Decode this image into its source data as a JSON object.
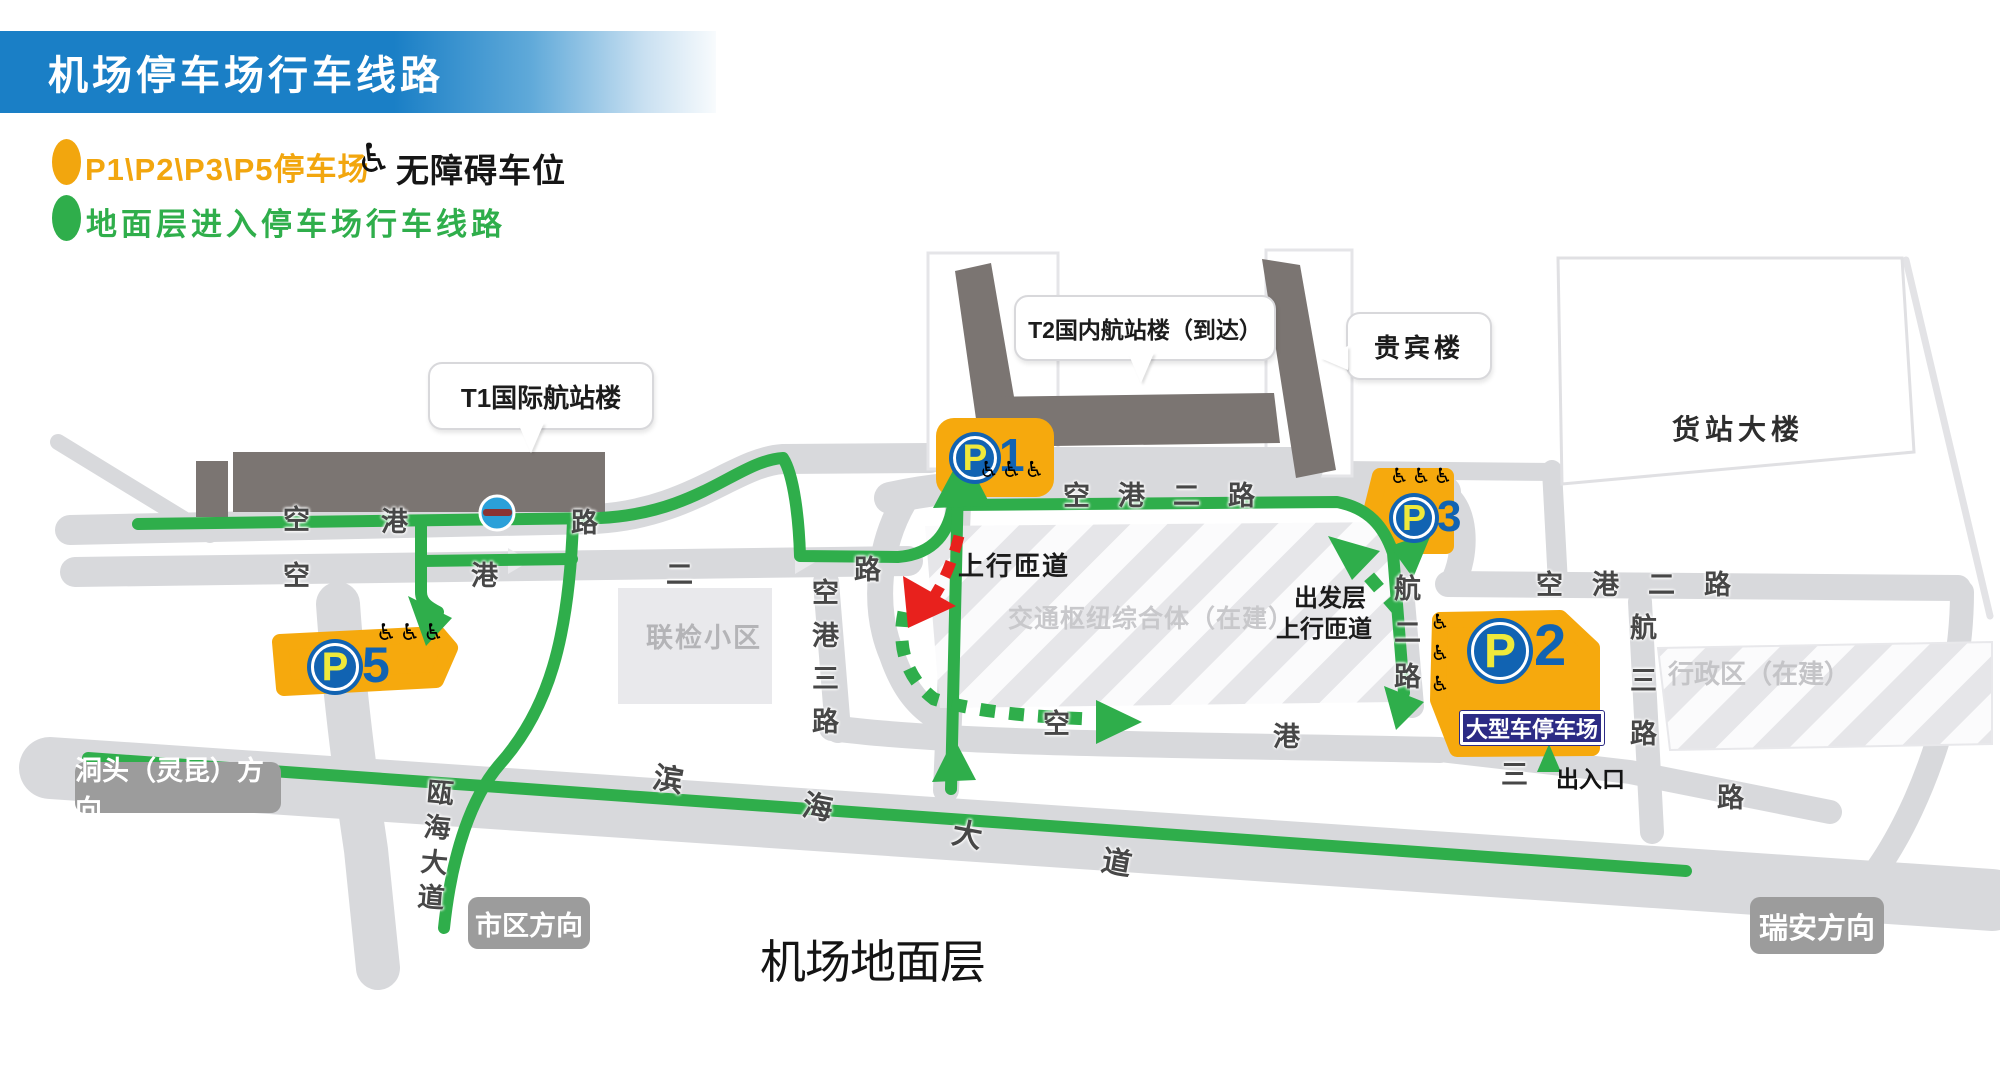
{
  "title": "机场停车场行车线路",
  "legend": {
    "parking_label": "P1\\P2\\P3\\P5停车场",
    "wheelchair_icon": "♿",
    "accessible_label": "无障碍车位",
    "route_label": "地面层进入停车场行车线路",
    "parking_color": "#f2a60e",
    "route_color": "#2fae4b"
  },
  "callouts": {
    "t1": "T1国际航站楼",
    "t2": "T2国内航站楼（到达）",
    "vip": "贵宾楼"
  },
  "zones": {
    "cargo": "货站大楼",
    "inspection": "联检小区",
    "hub": "交通枢纽综合体（在建）",
    "admin": "行政区（在建）"
  },
  "parking": {
    "p1": {
      "letter": "P",
      "number": "1",
      "wheelchairs": "♿♿♿"
    },
    "p2": {
      "letter": "P",
      "number": "2",
      "wheelchairs": "♿♿♿",
      "large_vehicle_label": "大型车停车场",
      "entrance_label": "出入口"
    },
    "p3": {
      "letter": "P",
      "number": "3",
      "wheelchairs": "♿♿♿"
    },
    "p5": {
      "letter": "P",
      "number": "5",
      "wheelchairs": "♿♿♿"
    }
  },
  "ramps": {
    "up_ramp": "上行匝道",
    "departure_line1": "出发层",
    "departure_line2": "上行匝道"
  },
  "directions": {
    "dongtou": "洞头（灵昆）方向",
    "city": "市区方向",
    "ruian": "瑞安方向"
  },
  "roads": {
    "kg1_chars": [
      "空",
      "港",
      "路"
    ],
    "kg2_mid_chars": [
      "空",
      "港",
      "二",
      "路"
    ],
    "kg2_top": "空港二路",
    "kg2_right": "空港二路",
    "kg3_vertical": "空港三路",
    "kg3_east_chars": [
      "空",
      "港",
      "三",
      "路"
    ],
    "hang2": "航二路",
    "hang3": "航三路",
    "binhai": "滨海大道",
    "ouhai": "瓯海大道"
  },
  "footer": "机场地面层"
}
